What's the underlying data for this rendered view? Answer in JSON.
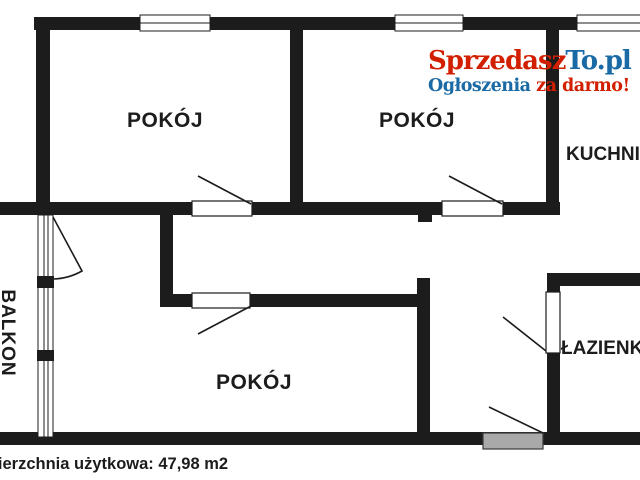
{
  "logo": {
    "brand_part1": "Sprzedasz",
    "brand_part2": "To.pl",
    "tagline_part1": "Ogłoszenia ",
    "tagline_part2": "za darmo!"
  },
  "rooms": {
    "room1": {
      "label": "POKÓJ"
    },
    "room2": {
      "label": "POKÓJ"
    },
    "room3": {
      "label": "POKÓJ"
    },
    "kitchen": {
      "label": "KUCHNIA"
    },
    "bathroom": {
      "label": "ŁAZIENKA"
    },
    "balcony": {
      "label": "BALKON"
    }
  },
  "footer": {
    "usable_area_label": "Powierzchnia użytkowa: 47,98 m2"
  },
  "colors": {
    "brand_red": "#d21f00",
    "brand_blue": "#1a6aa5",
    "wall": "#1c1c1c",
    "entrance_door_fill": "#a9a9a9"
  }
}
